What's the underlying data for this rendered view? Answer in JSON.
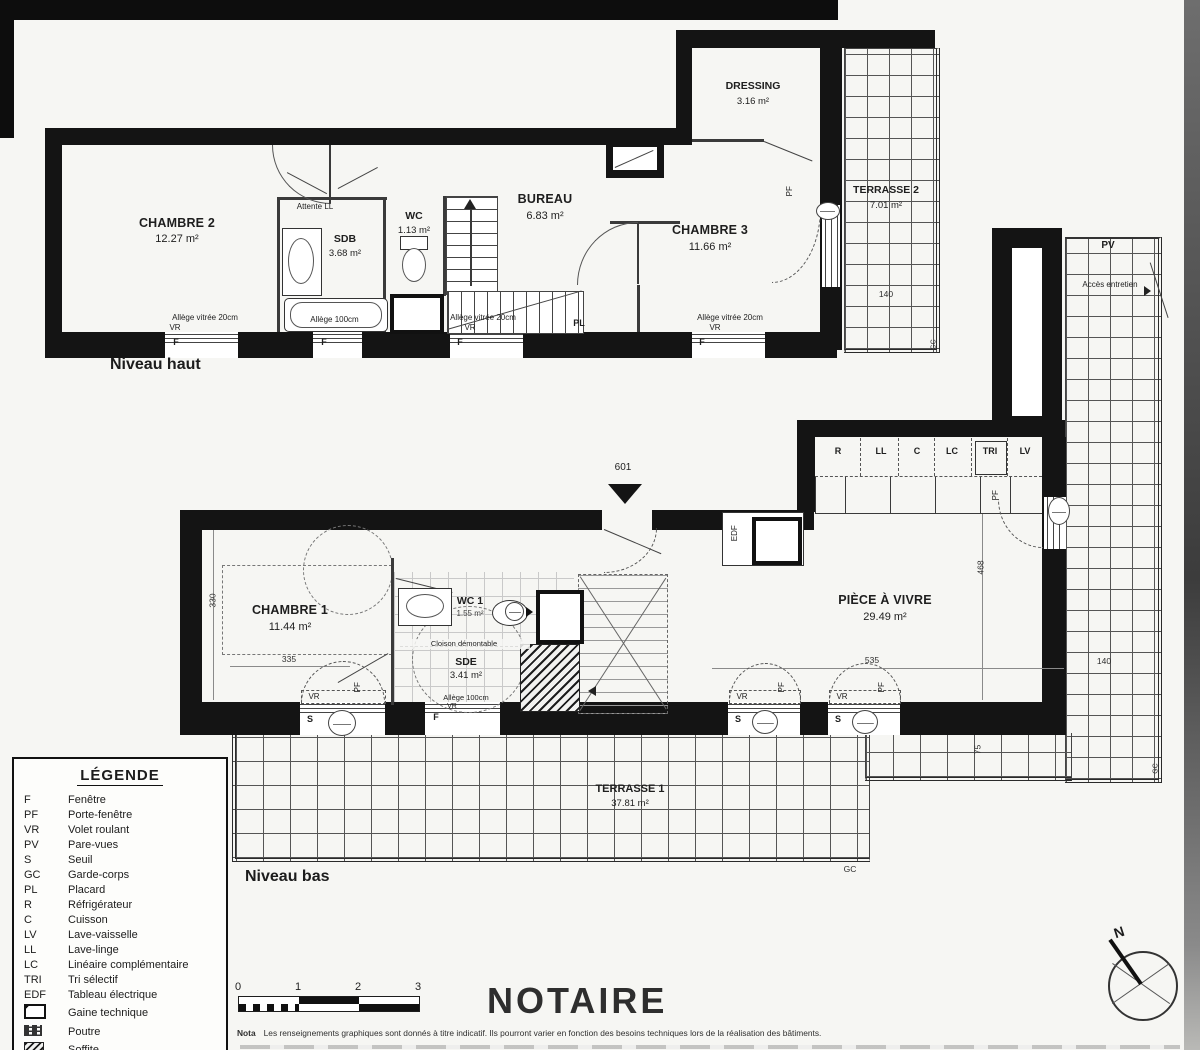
{
  "page": {
    "niveau_haut_label": "Niveau haut",
    "niveau_bas_label": "Niveau bas",
    "unit_number": "601",
    "notaire_title": "NOTAIRE",
    "nota_label": "Nota",
    "nota_text": "Les renseignements graphiques sont donnés à titre indicatif. Ils pourront varier en fonction des besoins techniques lors de la réalisation des bâtiments.",
    "north_label": "N"
  },
  "rooms": {
    "chambre2": {
      "name": "CHAMBRE 2",
      "area": "12.27 m²"
    },
    "sdb": {
      "name": "SDB",
      "area": "3.68 m²"
    },
    "wc": {
      "name": "WC",
      "area": "1.13 m²"
    },
    "bureau": {
      "name": "BUREAU",
      "area": "6.83 m²"
    },
    "chambre3": {
      "name": "CHAMBRE 3",
      "area": "11.66 m²"
    },
    "dressing": {
      "name": "DRESSING",
      "area": "3.16 m²"
    },
    "terrasse2": {
      "name": "TERRASSE 2",
      "area": "7.01 m²"
    },
    "chambre1": {
      "name": "CHAMBRE 1",
      "area": "11.44 m²"
    },
    "wc1": {
      "name": "WC 1",
      "area": "1.55 m²"
    },
    "sde": {
      "name": "SDE",
      "area": "3.41 m²"
    },
    "piece_a_vivre": {
      "name": "PIÈCE À VIVRE",
      "area": "29.49 m²"
    },
    "terrasse1": {
      "name": "TERRASSE 1",
      "area": "37.81 m²"
    }
  },
  "annotations": {
    "attente_ll": "Attente LL",
    "allege_vitree_20": "Allège vitrée 20cm",
    "allege_100": "Allège 100cm",
    "cloison_demontable": "Cloison démontable",
    "acces_entretien": "Accès entretien"
  },
  "markers": {
    "fenetre": "F",
    "porte_fenetre": "PF",
    "volet_roulant": "VR",
    "seuil": "S",
    "garde_corps": "GC",
    "placard": "PL",
    "pare_vues": "PV",
    "edf": "EDF"
  },
  "kitchen_units": [
    "R",
    "LL",
    "C",
    "LC",
    "TRI",
    "LV"
  ],
  "dimensions": {
    "d330": "330",
    "d335": "335",
    "d468": "468",
    "d535": "535",
    "d140": "140",
    "d75": "75"
  },
  "legend": {
    "title": "LÉGENDE",
    "items": [
      {
        "code": "F",
        "label": "Fenêtre"
      },
      {
        "code": "PF",
        "label": "Porte-fenêtre"
      },
      {
        "code": "VR",
        "label": "Volet roulant"
      },
      {
        "code": "PV",
        "label": "Pare-vues"
      },
      {
        "code": "S",
        "label": "Seuil"
      },
      {
        "code": "GC",
        "label": "Garde-corps"
      },
      {
        "code": "PL",
        "label": "Placard"
      },
      {
        "code": "R",
        "label": "Réfrigérateur"
      },
      {
        "code": "C",
        "label": "Cuisson"
      },
      {
        "code": "LV",
        "label": "Lave-vaisselle"
      },
      {
        "code": "LL",
        "label": "Lave-linge"
      },
      {
        "code": "LC",
        "label": "Linéaire complémentaire"
      },
      {
        "code": "TRI",
        "label": "Tri sélectif"
      },
      {
        "code": "EDF",
        "label": "Tableau électrique"
      },
      {
        "code": "",
        "label": "Gaine technique",
        "icon": "gaine-technique-icon"
      },
      {
        "code": "",
        "label": "Poutre",
        "icon": "poutre-icon"
      },
      {
        "code": "",
        "label": "Soffite",
        "icon": "soffite-icon"
      }
    ]
  },
  "scale_bar": {
    "ticks": [
      "0",
      "1",
      "2",
      "3"
    ]
  }
}
